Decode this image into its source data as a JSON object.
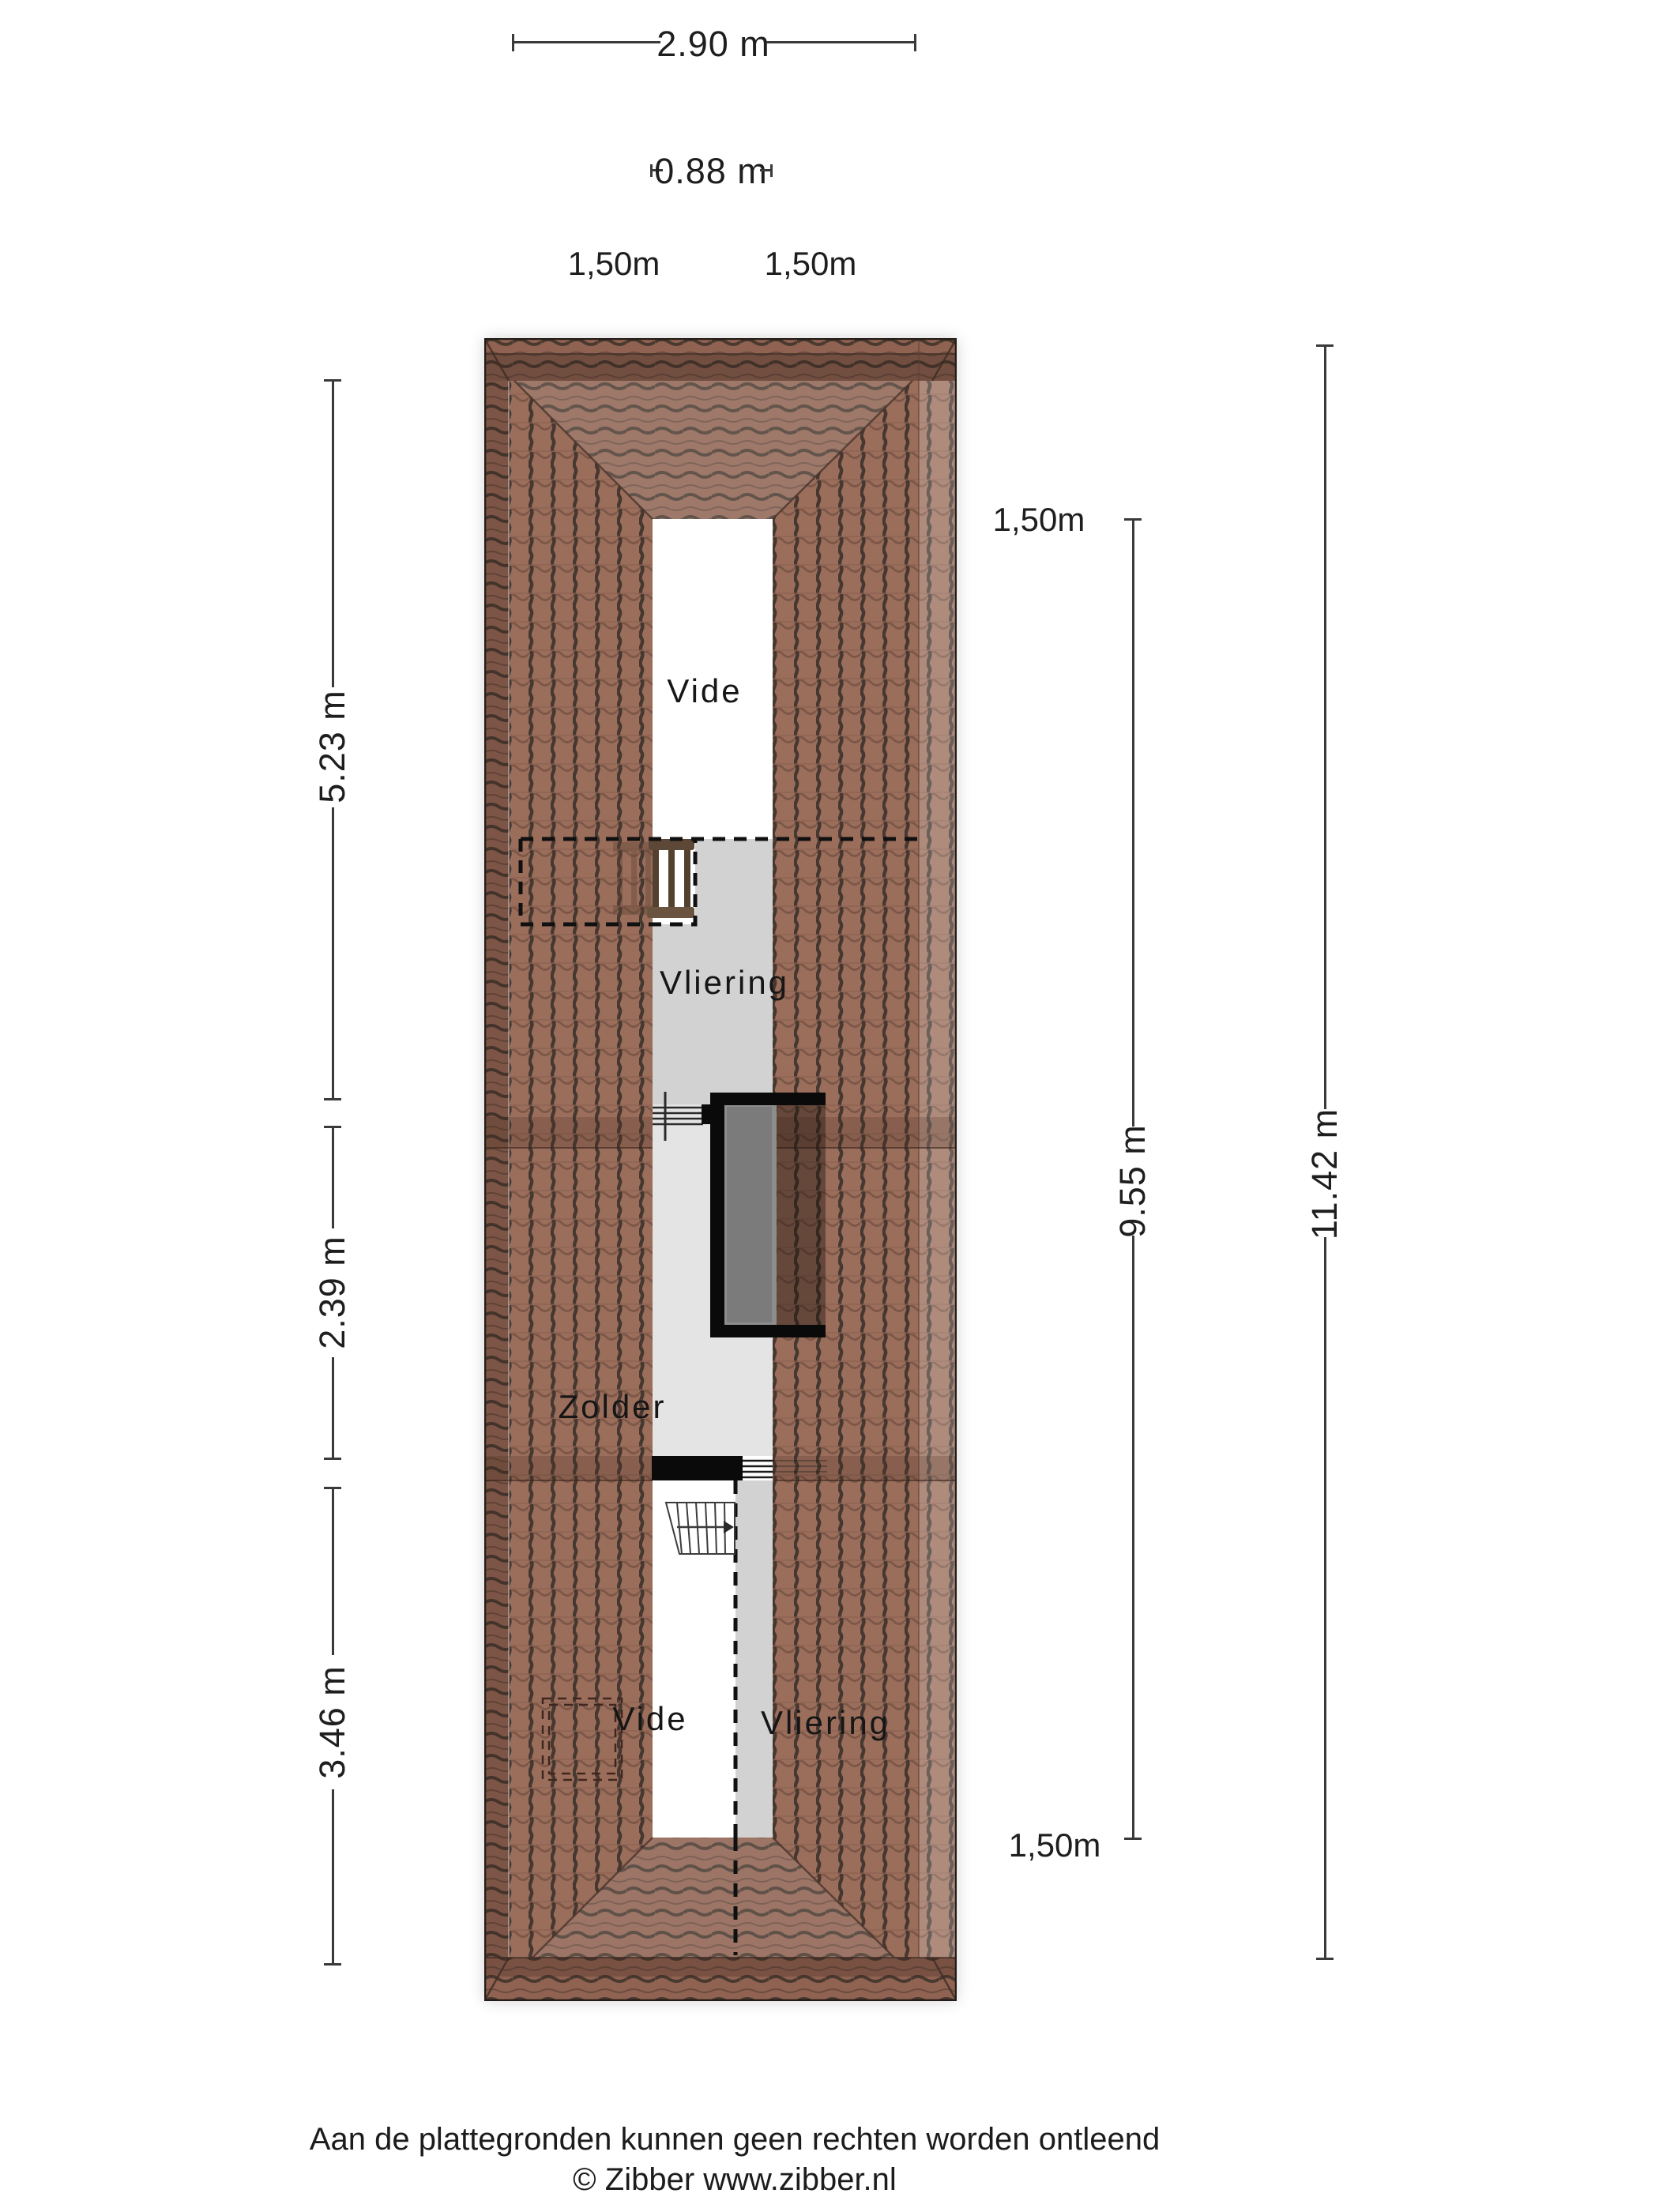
{
  "dimensions": {
    "top_width": "2.90 m",
    "vide_width": "0.88 m",
    "slope_left": "1,50m",
    "slope_right": "1,50m",
    "left_sections": [
      "5.23 m",
      "2.39 m",
      "3.46 m"
    ],
    "right_inner": "9.55 m",
    "right_total": "11.42 m",
    "right_top": "1,50m",
    "right_bottom": "1,50m"
  },
  "rooms": {
    "vide_top": "Vide",
    "vliering_top": "Vliering",
    "zolder": "Zolder",
    "vide_bottom": "Vide",
    "vliering_bottom": "Vliering"
  },
  "footer": {
    "disclaimer": "Aan de plattegronden kunnen geen rechten worden ontleend",
    "copyright": "© Zibber www.zibber.nl"
  },
  "colors": {
    "roof_tile": "#9b6e5c",
    "roof_tile_line": "#463830",
    "roof_band_dark": "#6e4a3c",
    "roof_trapezoid_light": "#a87f6c",
    "floor_vliering": "#d2d2d2",
    "floor_zolder": "#e4e4e4",
    "stairwell_fill": "#7b7b7b",
    "wall_black": "#0a0a0a",
    "dimension_text": "#1e1e1e"
  }
}
